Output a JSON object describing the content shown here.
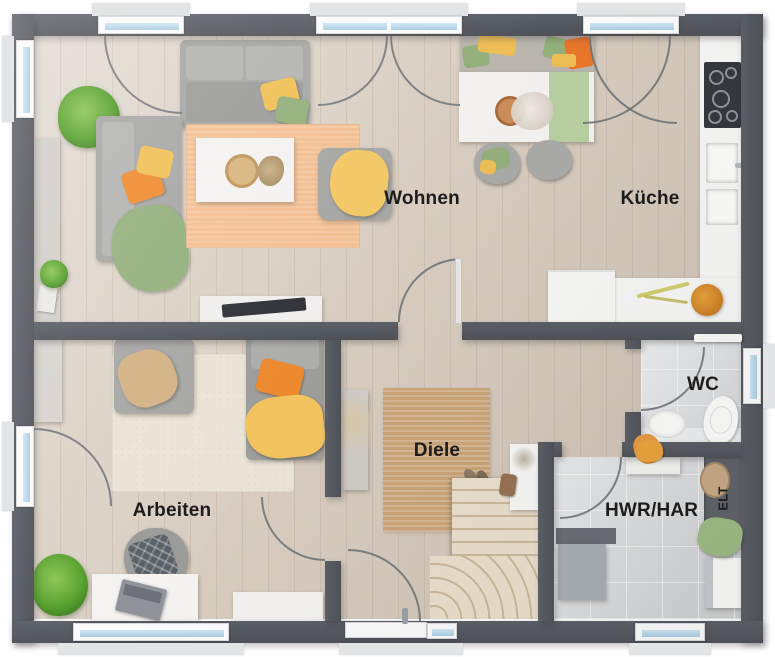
{
  "rooms": {
    "wohnen": {
      "label": "Wohnen"
    },
    "kueche": {
      "label": "Küche"
    },
    "arbeiten": {
      "label": "Arbeiten"
    },
    "diele": {
      "label": "Diele"
    },
    "wc": {
      "label": "WC"
    },
    "hwr": {
      "label": "HWR/HAR"
    },
    "elt": {
      "label": "ELT"
    }
  },
  "colors": {
    "wall": "#53575d",
    "floor_wood": "#d8cdc0",
    "floor_tile": "#d3d5d7",
    "counter_white": "#f6f6f5",
    "rug_orange": "#f3bf92",
    "rug_jute": "#c9a478",
    "rug_cream": "#ebe4d6",
    "sofa_gray": "#a6a6a4",
    "accent_orange": "#ed8a2f",
    "accent_yellow": "#f2c35e",
    "accent_green": "#93af7a",
    "window_glass": "#b8d9ec",
    "label_text": "#1c1c1c"
  }
}
